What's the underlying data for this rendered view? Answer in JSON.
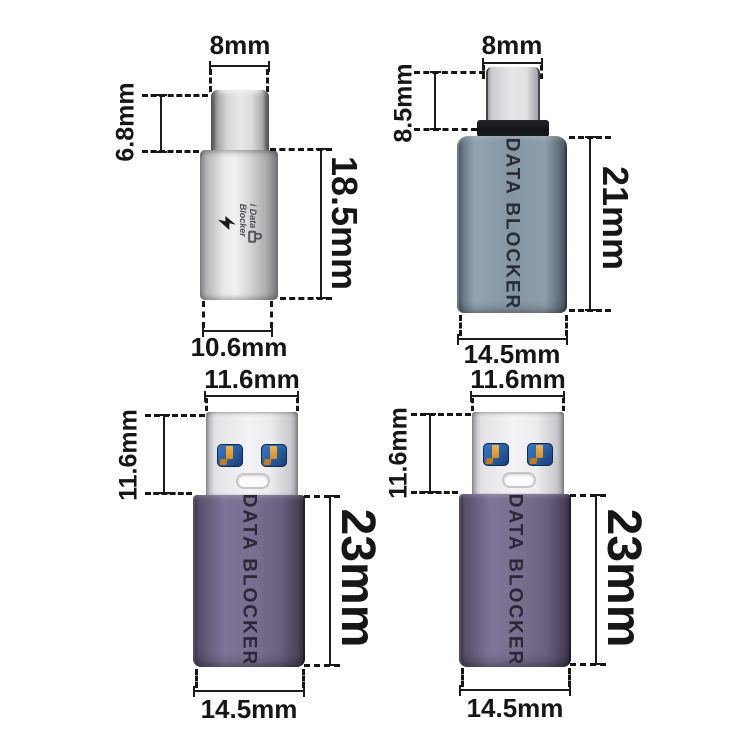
{
  "title": "USB data blocker adapters dimension diagram",
  "colors": {
    "background": "#ffffff",
    "dimension_lines": "#161616",
    "silver_body": "#d9d9db",
    "grey_blue_body": "#8595a2",
    "purple_body": "#786e8e",
    "collar_black": "#17181a",
    "usb_contact_blue": "#2a63ac",
    "usb_contact_gold": "#e9a63c",
    "engraved_text_grey": "#272e36",
    "engraved_text_purple": "#2c2638"
  },
  "adapters": [
    {
      "name": "usb-c-adapter-silver",
      "top_width": "8mm",
      "plug_height": "6.8mm",
      "body_height": "18.5mm",
      "bottom_width": "10.6mm",
      "logo_line1": "i Data",
      "logo_line2": "Blocker"
    },
    {
      "name": "usb-c-adapter-grey",
      "top_width": "8mm",
      "plug_height": "8.5mm",
      "body_height": "21mm",
      "bottom_width": "14.5mm",
      "body_text": "DATA BLOCKER"
    },
    {
      "name": "usb-a-adapter-purple-left",
      "top_width": "11.6mm",
      "plug_height": "11.6mm",
      "body_height": "23mm",
      "bottom_width": "14.5mm",
      "body_text": "DATA BLOCKER"
    },
    {
      "name": "usb-a-adapter-purple-right",
      "top_width": "11.6mm",
      "plug_height": "11.6mm",
      "body_height": "23mm",
      "bottom_width": "14.5mm",
      "body_text": "DATA BLOCKER"
    }
  ]
}
